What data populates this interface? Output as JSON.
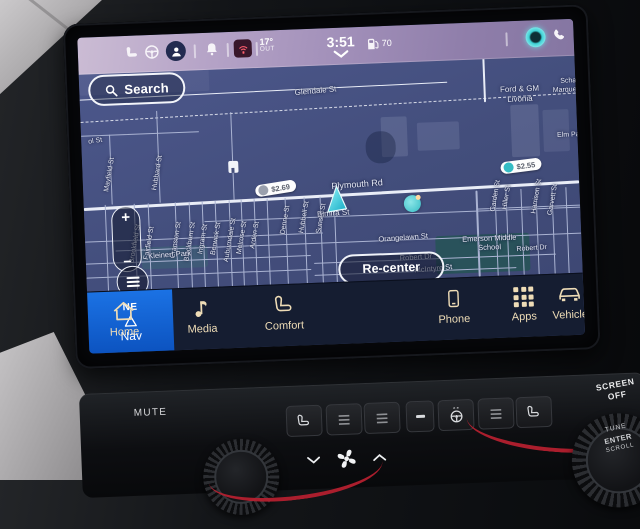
{
  "status_bar": {
    "temp": "17°",
    "temp_unit": "OUT",
    "time": "3:51",
    "fuel_level": "70",
    "icons": [
      "seat-icon",
      "steering-wheel-icon",
      "profile-avatar-icon",
      "bell-icon",
      "phone-signal-icon",
      "fuel-pump-icon",
      "chevron-down-icon",
      "voice-assistant-icon",
      "phone-handset-icon"
    ]
  },
  "map": {
    "search_label": "Search",
    "recenter_label": "Re-center",
    "zoom_in": "+",
    "zoom_out": "−",
    "price_badges": [
      {
        "text": "$2.69"
      },
      {
        "text": "$2.55"
      }
    ],
    "labels": [
      {
        "t": "Glendale St",
        "x": 236,
        "y": 26,
        "r": -3,
        "s": 8
      },
      {
        "t": "Ford & GM",
        "x": 440,
        "y": 32,
        "r": 0,
        "s": 8
      },
      {
        "t": "Livonia",
        "x": 440,
        "y": 42,
        "r": 0,
        "s": 8
      },
      {
        "t": "Scha",
        "x": 489,
        "y": 26,
        "r": 0,
        "s": 7
      },
      {
        "t": "Marquet",
        "x": 486,
        "y": 35,
        "r": 0,
        "s": 7
      },
      {
        "t": "Elm Pa",
        "x": 487,
        "y": 80,
        "r": 0,
        "s": 7
      },
      {
        "t": "ol St",
        "x": 14,
        "y": 68,
        "r": -6,
        "s": 7
      },
      {
        "t": "Mayfield St",
        "x": 27,
        "y": 102,
        "r": -78,
        "s": 7
      },
      {
        "t": "Hubbard St",
        "x": 75,
        "y": 102,
        "r": -78,
        "s": 7
      },
      {
        "t": "Plymouth Rd",
        "x": 274,
        "y": 121,
        "r": -2,
        "s": 9
      },
      {
        "t": "Elmira St",
        "x": 249,
        "y": 149,
        "r": -2,
        "s": 8
      },
      {
        "t": "Denne St",
        "x": 201,
        "y": 154,
        "r": -78,
        "s": 7
      },
      {
        "t": "Hubbell St",
        "x": 220,
        "y": 152,
        "r": -78,
        "s": 7
      },
      {
        "t": "Sunset St",
        "x": 237,
        "y": 154,
        "r": -78,
        "s": 7
      },
      {
        "t": "Brookfield St",
        "x": 50,
        "y": 172,
        "r": -78,
        "s": 7
      },
      {
        "t": "Fairfield St",
        "x": 64,
        "y": 172,
        "r": -78,
        "s": 7
      },
      {
        "t": "Cranston St",
        "x": 91,
        "y": 170,
        "r": -78,
        "s": 7
      },
      {
        "t": "Blackburn St",
        "x": 105,
        "y": 172,
        "r": -78,
        "s": 7
      },
      {
        "t": "Ingram St",
        "x": 118,
        "y": 170,
        "r": -78,
        "s": 7
      },
      {
        "t": "Berwick St",
        "x": 131,
        "y": 170,
        "r": -78,
        "s": 7
      },
      {
        "t": "Auburndale St",
        "x": 145,
        "y": 172,
        "r": -78,
        "s": 7
      },
      {
        "t": "Melrose St",
        "x": 157,
        "y": 170,
        "r": -78,
        "s": 7
      },
      {
        "t": "Arden St",
        "x": 170,
        "y": 168,
        "r": -78,
        "s": 7
      },
      {
        "t": "Kleinert Park",
        "x": 84,
        "y": 184,
        "r": -2,
        "s": 7.5
      },
      {
        "t": "Orangelawn St",
        "x": 318,
        "y": 176,
        "r": -2,
        "s": 7.5
      },
      {
        "t": "Robert Dr",
        "x": 330,
        "y": 196,
        "r": -2,
        "s": 7.5
      },
      {
        "t": "Robert Dr",
        "x": 446,
        "y": 192,
        "r": -2,
        "s": 7
      },
      {
        "t": "McIntyre St",
        "x": 347,
        "y": 208,
        "r": -3,
        "s": 7.5
      },
      {
        "t": "Emerson Middle",
        "x": 404,
        "y": 180,
        "r": 0,
        "s": 7.5
      },
      {
        "t": "School",
        "x": 404,
        "y": 189,
        "r": 0,
        "s": 7.5
      },
      {
        "t": "Garden St",
        "x": 412,
        "y": 138,
        "r": -78,
        "s": 7
      },
      {
        "t": "Hiller St",
        "x": 423,
        "y": 140,
        "r": -78,
        "s": 7
      },
      {
        "t": "Harrison St",
        "x": 453,
        "y": 140,
        "r": -78,
        "s": 7
      },
      {
        "t": "Garvett St",
        "x": 469,
        "y": 144,
        "r": -78,
        "s": 7
      }
    ]
  },
  "nav_bar": {
    "compass": "NE",
    "items": [
      {
        "label": "Home",
        "icon": "home-icon"
      },
      {
        "label": "Media",
        "icon": "music-note-icon"
      },
      {
        "label": "Comfort",
        "icon": "seat-icon"
      },
      {
        "label": "Nav",
        "icon": "nav-triangle-icon",
        "active": true
      },
      {
        "label": "Phone",
        "icon": "smartphone-icon"
      },
      {
        "label": "Apps",
        "icon": "apps-grid-icon"
      },
      {
        "label": "Vehicle",
        "icon": "car-icon"
      }
    ]
  },
  "hard_controls": {
    "mute_label": "MUTE",
    "screen_off_label": "SCREEN\nOFF",
    "knob": {
      "tune": "TUNE",
      "enter": "ENTER",
      "scroll": "SCROLL"
    }
  },
  "colors": {
    "accent_blue": "#1565d8",
    "map_bg": "#454f7e",
    "assistant_teal": "#3ed2d6",
    "nav_text_cream": "#eedcb6",
    "red_trim": "#b92030",
    "status_bar_lavender": "#a795bb"
  }
}
